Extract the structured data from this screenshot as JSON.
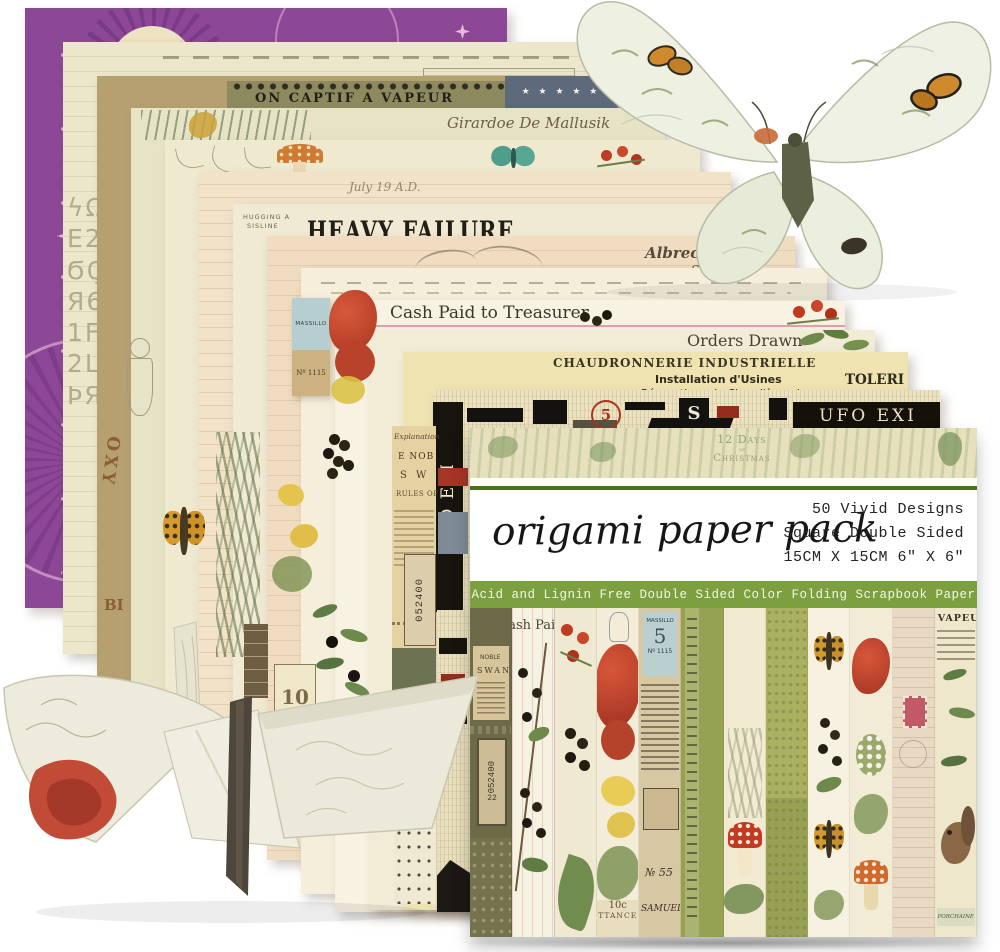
{
  "product": {
    "title": "origami paper pack",
    "specs": [
      "50 Vivid Designs",
      "Square Double Sided",
      "15CM X 15CM 6\" X 6\""
    ],
    "banner": "Acid and Lignin Free Double Sided Color Folding Scrapbook Paper"
  },
  "pack_top": {
    "days1": "12 Days",
    "days2": "of",
    "days3": "Christmas"
  },
  "frag": {
    "captif": "ON CAPTIF A VAPEUR",
    "girardoe": "Girardoe De Mallusik",
    "july": "July 19 A.D.",
    "y1859": "1859",
    "balance": "Balance",
    "hug1": "HUGGING A",
    "hug2": "SISLINE",
    "heavy": "HEAVY FAILURE",
    "durer": "Albrecht Dürer",
    "stiftung": "Stiftung",
    "dealer": "DEALER IN THE LEADIN",
    "pianos": "PIANOS",
    "cash": "Cash Paid to Treasurer",
    "orders": "Orders Drawn",
    "chaud": "CHAUDRONNERIE  INDUSTRIELLE",
    "install": "Installation d'Usines",
    "repar": "Réparations de Chaudières de",
    "toleri": "TOLERI",
    "ufo": "UFO EXI",
    "stars": "★ ★ ★ ★ ★",
    "explanation": "Explanation",
    "nob": "E NOB",
    "sw": "S W",
    "rules": "RULES OF",
    "ticket": "052400",
    "ticket2": "22",
    "ten": "10",
    "tencc": "10c",
    "ttance": "TTANCE",
    "samuel": "SAMUEL",
    "massillo": "MASSILLO",
    "five": "5",
    "no1115": "Nº 1115",
    "vapeu": "VAPEU",
    "porchaine": "PORCHAINE",
    "noble": "NOBLE",
    "swan": "SWAN",
    "oxy": "OXY",
    "bi": "BI",
    "rs55": "№ 55",
    "glyphs": [
      "ϟΩ26Ц",
      "Ε2Ϻ",
      "ϬϚϠ",
      "Я612",
      "1Ϝ6",
      "2ЦЏ",
      "ϷЯϏ"
    ]
  },
  "palette": {
    "purple": "#8c4897",
    "banner_green": "#7c9f3f",
    "rule_green": "#4a7019",
    "cream": "#ece7cb",
    "ink": "#1a1a1a"
  }
}
